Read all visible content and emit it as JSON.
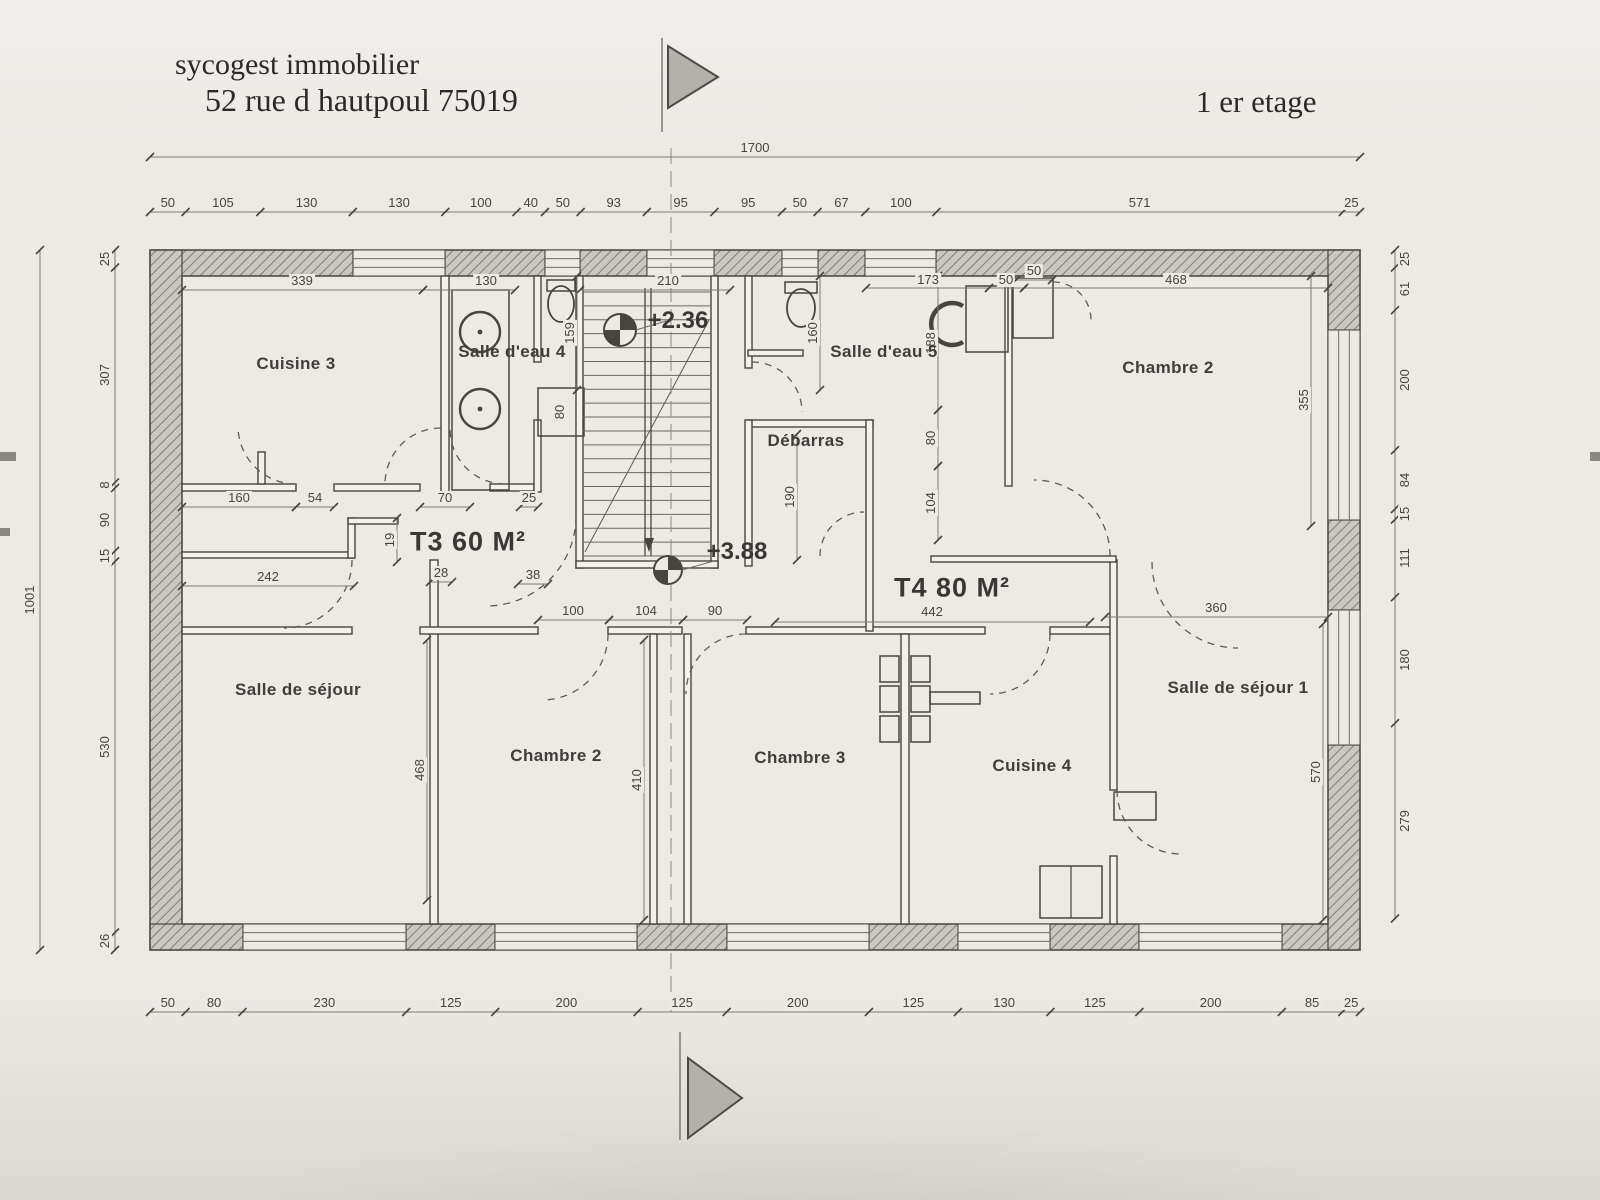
{
  "header": {
    "company": "sycogest immobilier",
    "address": "52 rue d hautpoul 75019",
    "floor_label": "1 er etage"
  },
  "plan": {
    "apartments": [
      {
        "label": "T3 60 M²",
        "x": 468,
        "y": 542
      },
      {
        "label": "T4 80 M²",
        "x": 952,
        "y": 588
      }
    ],
    "rooms": [
      {
        "label": "Cuisine 3",
        "x": 296,
        "y": 364
      },
      {
        "label": "Salle d'eau 4",
        "x": 512,
        "y": 352
      },
      {
        "label": "Salle d'eau 5",
        "x": 884,
        "y": 352
      },
      {
        "label": "Chambre 2",
        "x": 1168,
        "y": 368
      },
      {
        "label": "Débarras",
        "x": 806,
        "y": 441
      },
      {
        "label": "Salle de séjour",
        "x": 298,
        "y": 690
      },
      {
        "label": "Chambre 2",
        "x": 556,
        "y": 756
      },
      {
        "label": "Chambre 3",
        "x": 800,
        "y": 758
      },
      {
        "label": "Cuisine 4",
        "x": 1032,
        "y": 766
      },
      {
        "label": "Salle de séjour 1",
        "x": 1238,
        "y": 688
      }
    ],
    "levels": [
      {
        "label": "+2.36",
        "x": 678,
        "y": 321,
        "sx": 620,
        "sy": 330,
        "r": 16
      },
      {
        "label": "+3.88",
        "x": 737,
        "y": 552,
        "sx": 668,
        "sy": 570,
        "r": 14
      }
    ],
    "dims": {
      "chains": [
        {
          "dir": "h",
          "at": 157,
          "side": -1,
          "ticks": [
            150,
            1360
          ],
          "values": [
            "1700"
          ]
        },
        {
          "dir": "h",
          "at": 212,
          "side": -1,
          "ticks": [
            150,
            185.6,
            260.3,
            352.8,
            445.3,
            516.5,
            545,
            580.6,
            646.8,
            714.4,
            782,
            817.6,
            865.3,
            936.4,
            1342.8,
            1360
          ],
          "values": [
            "50",
            "105",
            "130",
            "130",
            "100",
            "40",
            "50",
            "93",
            "95",
            "95",
            "50",
            "67",
            "100",
            "571",
            "25"
          ]
        },
        {
          "dir": "h",
          "at": 1012,
          "side": -1,
          "ticks": [
            150,
            185.6,
            242.5,
            406.2,
            495.2,
            637.6,
            726.6,
            868.9,
            957.9,
            1050.4,
            1139.4,
            1281.8,
            1342.3,
            1360
          ],
          "values": [
            "50",
            "80",
            "230",
            "125",
            "200",
            "125",
            "200",
            "125",
            "130",
            "125",
            "200",
            "85",
            "25"
          ]
        },
        {
          "dir": "v",
          "at": 40,
          "side": -1,
          "ticks": [
            250,
            950
          ],
          "values": [
            "1001"
          ]
        },
        {
          "dir": "v",
          "at": 115,
          "side": -1,
          "ticks": [
            250,
            267.5,
            482.4,
            488,
            551,
            561.5,
            932.5,
            950
          ],
          "values": [
            "25",
            "307",
            "8",
            "90",
            "15",
            "530",
            "26"
          ]
        },
        {
          "dir": "v",
          "at": 1395,
          "side": 1,
          "ticks": [
            250,
            267.5,
            310.2,
            450.2,
            509,
            519.5,
            597.2,
            723.2,
            918.5
          ],
          "values": [
            "25",
            "61",
            "200",
            "84",
            "15",
            "111",
            "180",
            "279"
          ]
        }
      ],
      "interior": [
        {
          "t": "339",
          "x": 302,
          "y": 281
        },
        {
          "t": "130",
          "x": 486,
          "y": 281
        },
        {
          "t": "210",
          "x": 668,
          "y": 281
        },
        {
          "t": "173",
          "x": 928,
          "y": 280
        },
        {
          "t": "50",
          "x": 1006,
          "y": 280
        },
        {
          "t": "468",
          "x": 1176,
          "y": 280
        },
        {
          "t": "50",
          "x": 1034,
          "y": 271
        },
        {
          "t": "160",
          "x": 239,
          "y": 498
        },
        {
          "t": "54",
          "x": 315,
          "y": 498
        },
        {
          "t": "70",
          "x": 445,
          "y": 498
        },
        {
          "t": "25",
          "x": 529,
          "y": 498
        },
        {
          "t": "242",
          "x": 268,
          "y": 577
        },
        {
          "t": "28",
          "x": 441,
          "y": 573
        },
        {
          "t": "38",
          "x": 533,
          "y": 575
        },
        {
          "t": "100",
          "x": 573,
          "y": 611
        },
        {
          "t": "104",
          "x": 646,
          "y": 611
        },
        {
          "t": "90",
          "x": 715,
          "y": 611
        },
        {
          "t": "442",
          "x": 932,
          "y": 612
        },
        {
          "t": "360",
          "x": 1216,
          "y": 608
        },
        {
          "t": "159",
          "x": 570,
          "y": 333,
          "r": 1
        },
        {
          "t": "80",
          "x": 560,
          "y": 412,
          "r": 1
        },
        {
          "t": "160",
          "x": 813,
          "y": 333,
          "r": 1
        },
        {
          "t": "188",
          "x": 931,
          "y": 343,
          "r": 1
        },
        {
          "t": "80",
          "x": 931,
          "y": 438,
          "r": 1
        },
        {
          "t": "104",
          "x": 931,
          "y": 503,
          "r": 1
        },
        {
          "t": "190",
          "x": 790,
          "y": 497,
          "r": 1
        },
        {
          "t": "355",
          "x": 1304,
          "y": 400,
          "r": 1
        },
        {
          "t": "19",
          "x": 390,
          "y": 540,
          "r": 1
        },
        {
          "t": "468",
          "x": 420,
          "y": 770,
          "r": 1
        },
        {
          "t": "410",
          "x": 637,
          "y": 780,
          "r": 1
        },
        {
          "t": "570",
          "x": 1316,
          "y": 772,
          "r": 1
        }
      ]
    }
  }
}
